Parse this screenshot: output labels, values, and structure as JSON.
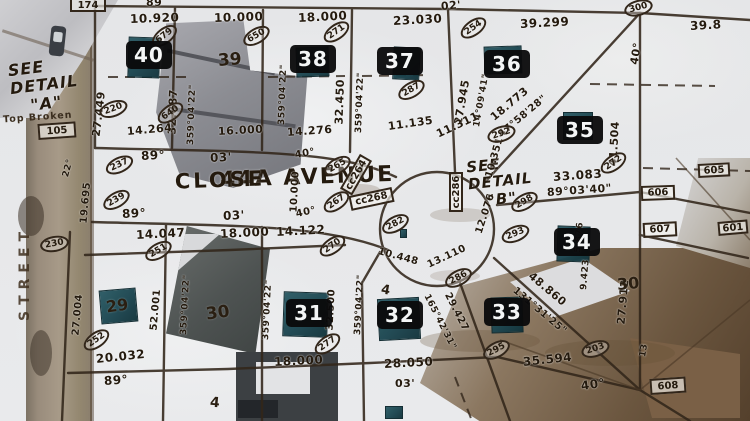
{
  "colors": {
    "linework": "#32261a",
    "label_text": "#241a0e",
    "badge_bg": "#0a0a0b",
    "badge_text": "#ffffff",
    "survey_marker": "#1b454f",
    "snow": "#e7e8ea",
    "road": "#998c7c"
  },
  "street": {
    "name_line1": "44A AVENUE",
    "name_line2": "CLOSE",
    "side_street": "STREET"
  },
  "callouts": {
    "detail_a_1": "SEE",
    "detail_a_2": "DETAIL",
    "detail_a_3": "\"A\"",
    "detail_b_1": "SEE",
    "detail_b_2": "DETAIL",
    "detail_b_3": "\"B\"",
    "note": "Top Broken"
  },
  "lot_badges": [
    {
      "text": "40",
      "x": 126,
      "y": 41
    },
    {
      "text": "38",
      "x": 290,
      "y": 45
    },
    {
      "text": "37",
      "x": 377,
      "y": 47
    },
    {
      "text": "36",
      "x": 484,
      "y": 50
    },
    {
      "text": "35",
      "x": 557,
      "y": 116
    },
    {
      "text": "34",
      "x": 554,
      "y": 228
    },
    {
      "text": "33",
      "x": 484,
      "y": 298
    },
    {
      "text": "32",
      "x": 377,
      "y": 301
    },
    {
      "text": "31",
      "x": 286,
      "y": 299
    }
  ],
  "plat_lot_numbers": [
    {
      "text": "39",
      "x": 218,
      "y": 50,
      "rot": -5,
      "fs": 17
    },
    {
      "text": "30",
      "x": 206,
      "y": 303,
      "rot": -8,
      "fs": 17
    },
    {
      "text": "30",
      "x": 617,
      "y": 274,
      "rot": -5,
      "fs": 16
    },
    {
      "text": "29",
      "x": 106,
      "y": 296,
      "rot": -8,
      "fs": 16
    },
    {
      "text": "4",
      "x": 381,
      "y": 283,
      "rot": 10,
      "fs": 13
    },
    {
      "text": "4",
      "x": 210,
      "y": 395,
      "rot": 5,
      "fs": 14
    }
  ],
  "dimension_labels": [
    {
      "text": "10.920",
      "x": 130,
      "y": 12,
      "rot": -2,
      "fs": 12
    },
    {
      "text": "10.000",
      "x": 214,
      "y": 11,
      "rot": -2,
      "fs": 12
    },
    {
      "text": "18.000",
      "x": 298,
      "y": 11,
      "rot": -3,
      "fs": 12
    },
    {
      "text": "23.030",
      "x": 393,
      "y": 14,
      "rot": -3,
      "fs": 12
    },
    {
      "text": "02'",
      "x": 441,
      "y": 0,
      "rot": -5,
      "fs": 11
    },
    {
      "text": "39.299",
      "x": 520,
      "y": 17,
      "rot": -3,
      "fs": 12
    },
    {
      "text": "39.8",
      "x": 690,
      "y": 19,
      "rot": -3,
      "fs": 12
    },
    {
      "text": "89",
      "x": 146,
      "y": -4,
      "rot": 0,
      "fs": 11
    },
    {
      "text": "27.449",
      "x": 96,
      "y": 130,
      "rot": -83,
      "fs": 11
    },
    {
      "text": "32.887",
      "x": 172,
      "y": 128,
      "rot": -88,
      "fs": 11
    },
    {
      "text": "359°04'22\"",
      "x": 191,
      "y": 140,
      "rot": -88,
      "fs": 9
    },
    {
      "text": "359°04'22\"",
      "x": 282,
      "y": 120,
      "rot": -88,
      "fs": 9
    },
    {
      "text": "32.450",
      "x": 339,
      "y": 118,
      "rot": -88,
      "fs": 11
    },
    {
      "text": "359°04'22\"",
      "x": 359,
      "y": 128,
      "rot": -88,
      "fs": 9
    },
    {
      "text": "27.945",
      "x": 458,
      "y": 118,
      "rot": -80,
      "fs": 11
    },
    {
      "text": "14°09'41\"",
      "x": 477,
      "y": 122,
      "rot": -80,
      "fs": 9
    },
    {
      "text": "41.504",
      "x": 613,
      "y": 160,
      "rot": -87,
      "fs": 11
    },
    {
      "text": "40°",
      "x": 634,
      "y": 58,
      "rot": -80,
      "fs": 11
    },
    {
      "text": "18.773",
      "x": 492,
      "y": 112,
      "rot": -40,
      "fs": 11
    },
    {
      "text": "47°58'28\"",
      "x": 500,
      "y": 130,
      "rot": -40,
      "fs": 10
    },
    {
      "text": "11.135",
      "x": 388,
      "y": 120,
      "rot": -8,
      "fs": 11
    },
    {
      "text": "11.311",
      "x": 437,
      "y": 128,
      "rot": -25,
      "fs": 11
    },
    {
      "text": "10.351",
      "x": 489,
      "y": 172,
      "rot": -74,
      "fs": 10
    },
    {
      "text": "33.083",
      "x": 553,
      "y": 170,
      "rot": -4,
      "fs": 12
    },
    {
      "text": "89°03'40\"",
      "x": 547,
      "y": 186,
      "rot": -4,
      "fs": 11
    },
    {
      "text": "14.264",
      "x": 127,
      "y": 125,
      "rot": -5,
      "fs": 11
    },
    {
      "text": "16.000",
      "x": 218,
      "y": 125,
      "rot": -3,
      "fs": 11
    },
    {
      "text": "14.276",
      "x": 287,
      "y": 126,
      "rot": -4,
      "fs": 11
    },
    {
      "text": "89°",
      "x": 141,
      "y": 149,
      "rot": -3,
      "fs": 12
    },
    {
      "text": "03'",
      "x": 210,
      "y": 151,
      "rot": -3,
      "fs": 12
    },
    {
      "text": "89°",
      "x": 122,
      "y": 207,
      "rot": -3,
      "fs": 12
    },
    {
      "text": "03'",
      "x": 223,
      "y": 209,
      "rot": -3,
      "fs": 12
    },
    {
      "text": "19.695",
      "x": 84,
      "y": 218,
      "rot": -85,
      "fs": 10
    },
    {
      "text": "22°",
      "x": 66,
      "y": 172,
      "rot": -75,
      "fs": 9
    },
    {
      "text": "14.047",
      "x": 136,
      "y": 228,
      "rot": -3,
      "fs": 12
    },
    {
      "text": "18.000",
      "x": 220,
      "y": 227,
      "rot": -3,
      "fs": 12
    },
    {
      "text": "14.122",
      "x": 276,
      "y": 225,
      "rot": -3,
      "fs": 12
    },
    {
      "text": "40°",
      "x": 295,
      "y": 150,
      "rot": -10,
      "fs": 10
    },
    {
      "text": "10.000",
      "x": 294,
      "y": 207,
      "rot": -87,
      "fs": 10
    },
    {
      "text": "40°",
      "x": 296,
      "y": 209,
      "rot": -12,
      "fs": 10
    },
    {
      "text": "10.448",
      "x": 378,
      "y": 246,
      "rot": 15,
      "fs": 10
    },
    {
      "text": "13.110",
      "x": 428,
      "y": 260,
      "rot": -25,
      "fs": 10
    },
    {
      "text": "12.076",
      "x": 479,
      "y": 228,
      "rot": -72,
      "fs": 10
    },
    {
      "text": "27.004",
      "x": 76,
      "y": 330,
      "rot": -85,
      "fs": 10
    },
    {
      "text": "52.001",
      "x": 154,
      "y": 325,
      "rot": -85,
      "fs": 10
    },
    {
      "text": "359°04'22\"",
      "x": 184,
      "y": 330,
      "rot": -87,
      "fs": 9
    },
    {
      "text": "359°04'22\"",
      "x": 266,
      "y": 335,
      "rot": -87,
      "fs": 9
    },
    {
      "text": "32.500",
      "x": 330,
      "y": 325,
      "rot": -87,
      "fs": 10
    },
    {
      "text": "359°04'22\"",
      "x": 358,
      "y": 330,
      "rot": -87,
      "fs": 9
    },
    {
      "text": "165°42'31\"",
      "x": 426,
      "y": 290,
      "rot": 63,
      "fs": 9
    },
    {
      "text": "29.427",
      "x": 447,
      "y": 288,
      "rot": 63,
      "fs": 10
    },
    {
      "text": "48.860",
      "x": 530,
      "y": 268,
      "rot": 40,
      "fs": 11
    },
    {
      "text": "131°31'25\"",
      "x": 514,
      "y": 284,
      "rot": 40,
      "fs": 10
    },
    {
      "text": "27.912",
      "x": 621,
      "y": 318,
      "rot": -85,
      "fs": 11
    },
    {
      "text": "35.594",
      "x": 523,
      "y": 355,
      "rot": -6,
      "fs": 12
    },
    {
      "text": "40°",
      "x": 581,
      "y": 379,
      "rot": -8,
      "fs": 12
    },
    {
      "text": "20.032",
      "x": 96,
      "y": 352,
      "rot": -6,
      "fs": 12
    },
    {
      "text": "89°",
      "x": 104,
      "y": 374,
      "rot": -4,
      "fs": 12
    },
    {
      "text": "18.000",
      "x": 274,
      "y": 355,
      "rot": -3,
      "fs": 12
    },
    {
      "text": "28.050",
      "x": 384,
      "y": 357,
      "rot": -3,
      "fs": 12
    },
    {
      "text": "03'",
      "x": 395,
      "y": 377,
      "rot": 0,
      "fs": 11
    },
    {
      "text": "5.876",
      "x": 578,
      "y": 248,
      "rot": -85,
      "fs": 9
    },
    {
      "text": "9.423",
      "x": 584,
      "y": 285,
      "rot": -85,
      "fs": 9
    },
    {
      "text": "13",
      "x": 643,
      "y": 352,
      "rot": -80,
      "fs": 9
    }
  ],
  "parcel_ovals": [
    {
      "text": "679",
      "x": 150,
      "y": 28,
      "rot": -38
    },
    {
      "text": "220",
      "x": 99,
      "y": 101,
      "rot": -20
    },
    {
      "text": "640",
      "x": 156,
      "y": 105,
      "rot": -35
    },
    {
      "text": "650",
      "x": 242,
      "y": 28,
      "rot": -30
    },
    {
      "text": "271",
      "x": 322,
      "y": 24,
      "rot": -35
    },
    {
      "text": "287",
      "x": 397,
      "y": 82,
      "rot": -30
    },
    {
      "text": "254",
      "x": 459,
      "y": 20,
      "rot": -35
    },
    {
      "text": "300",
      "x": 624,
      "y": 0,
      "rot": -15
    },
    {
      "text": "292",
      "x": 487,
      "y": 126,
      "rot": -18
    },
    {
      "text": "237",
      "x": 105,
      "y": 157,
      "rot": -25
    },
    {
      "text": "239",
      "x": 102,
      "y": 192,
      "rot": -30
    },
    {
      "text": "230",
      "x": 40,
      "y": 236,
      "rot": -10
    },
    {
      "text": "251",
      "x": 144,
      "y": 243,
      "rot": -30
    },
    {
      "text": "252",
      "x": 82,
      "y": 332,
      "rot": -35
    },
    {
      "text": "265",
      "x": 323,
      "y": 158,
      "rot": -30
    },
    {
      "text": "267",
      "x": 322,
      "y": 194,
      "rot": -35
    },
    {
      "text": "270",
      "x": 318,
      "y": 238,
      "rot": -35
    },
    {
      "text": "277",
      "x": 313,
      "y": 336,
      "rot": -35
    },
    {
      "text": "282",
      "x": 381,
      "y": 216,
      "rot": -28
    },
    {
      "text": "286",
      "x": 444,
      "y": 270,
      "rot": -28
    },
    {
      "text": "293",
      "x": 501,
      "y": 226,
      "rot": -22
    },
    {
      "text": "298",
      "x": 510,
      "y": 194,
      "rot": -30
    },
    {
      "text": "272",
      "x": 599,
      "y": 155,
      "rot": -35
    },
    {
      "text": "295",
      "x": 482,
      "y": 342,
      "rot": -28
    },
    {
      "text": "203",
      "x": 581,
      "y": 341,
      "rot": -18
    }
  ],
  "ref_boxes": [
    {
      "text": "174",
      "x": 70,
      "y": -2,
      "w": 36,
      "h": 14,
      "rot": 0
    },
    {
      "text": "105",
      "x": 38,
      "y": 124,
      "w": 38,
      "h": 16,
      "rot": -4
    },
    {
      "text": "606",
      "x": 641,
      "y": 186,
      "w": 34,
      "h": 15,
      "rot": -2
    },
    {
      "text": "607",
      "x": 643,
      "y": 223,
      "w": 34,
      "h": 15,
      "rot": -3
    },
    {
      "text": "605",
      "x": 698,
      "y": 164,
      "w": 32,
      "h": 14,
      "rot": -3
    },
    {
      "text": "601",
      "x": 718,
      "y": 222,
      "w": 30,
      "h": 14,
      "rot": -5
    },
    {
      "text": "608",
      "x": 650,
      "y": 379,
      "w": 36,
      "h": 16,
      "rot": -4
    },
    {
      "text": "cc264",
      "x": 346,
      "y": 185,
      "w": 40,
      "h": 14,
      "rot": -60
    },
    {
      "text": "cc268",
      "x": 350,
      "y": 196,
      "w": 44,
      "h": 15,
      "rot": -12
    },
    {
      "text": "cc286",
      "x": 456,
      "y": 205,
      "w": 40,
      "h": 14,
      "rot": -90
    }
  ],
  "survey_markers": [
    {
      "x": 128,
      "y": 37,
      "w": 32,
      "h": 41,
      "rot": 2
    },
    {
      "x": 296,
      "y": 47,
      "w": 33,
      "h": 30,
      "rot": -2
    },
    {
      "x": 393,
      "y": 47,
      "w": 27,
      "h": 33,
      "rot": 3
    },
    {
      "x": 484,
      "y": 46,
      "w": 38,
      "h": 28,
      "rot": -2
    },
    {
      "x": 563,
      "y": 112,
      "w": 30,
      "h": 28,
      "rot": 0
    },
    {
      "x": 557,
      "y": 226,
      "w": 33,
      "h": 36,
      "rot": 2
    },
    {
      "x": 491,
      "y": 297,
      "w": 32,
      "h": 36,
      "rot": -2
    },
    {
      "x": 378,
      "y": 298,
      "w": 42,
      "h": 42,
      "rot": -3
    },
    {
      "x": 283,
      "y": 292,
      "w": 45,
      "h": 45,
      "rot": 2
    },
    {
      "x": 100,
      "y": 289,
      "w": 37,
      "h": 34,
      "rot": -5
    },
    {
      "x": 400,
      "y": 229,
      "w": 7,
      "h": 9,
      "rot": 0
    },
    {
      "x": 385,
      "y": 406,
      "w": 18,
      "h": 13,
      "rot": 0
    }
  ]
}
